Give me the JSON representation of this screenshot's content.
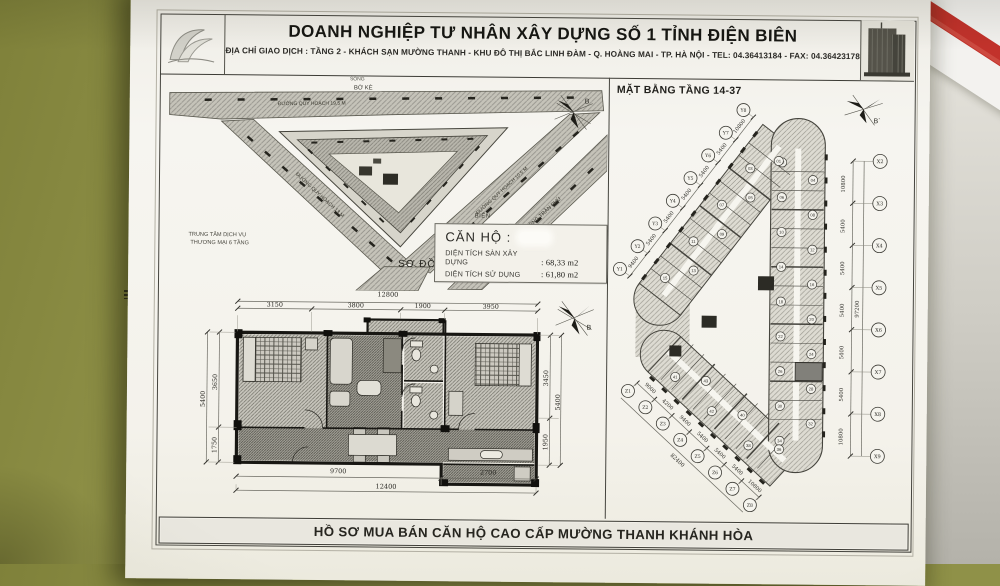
{
  "header": {
    "company": "DOANH NGHIỆP TƯ NHÂN XÂY DỰNG SỐ 1 TỈNH ĐIỆN BIÊN",
    "address": "ĐỊA CHỈ GIAO DỊCH : TẦNG 2 - KHÁCH SẠN MƯỜNG THANH - KHU ĐÔ THỊ BẮC LINH ĐÀM - Q. HOÀNG MAI - TP. HÀ NỘI - TEL: 04.36413184 - FAX: 04.36423178"
  },
  "site_plan": {
    "river": "SÔNG",
    "embankment": "BỜ KÈ",
    "road_top": "ĐƯỜNG QUY HOẠCH 19,5 M",
    "road_left": "ĐƯỜNG QUY HOẠCH 13 M",
    "road_right": "ĐƯỜNG QUY HOẠCH 10,5 M",
    "road_tran_phu": "ĐƯỜNG TRẦN PHÚ",
    "commercial_line1": "TRUNG TÂM DỊCH VỤ",
    "commercial_line2": "THƯƠNG MẠI 6 TẦNG",
    "sea": "BIỂN",
    "caption": "SƠ ĐỒ VỊ TRÍ"
  },
  "unit_info": {
    "title": "CĂN HỘ :",
    "floor_area_label": "DIỆN TÍCH SÀN XÂY DỰNG",
    "floor_area_value": ": 68,33 m2",
    "usable_area_label": "DIỆN TÍCH SỬ DỤNG",
    "usable_area_value": ": 61,80 m2"
  },
  "floor_plan": {
    "title": "MẶT BẰNG TẦNG 14-37",
    "compass_b": "B",
    "compass_b2": "B`",
    "x_axis": [
      "X2",
      "X3",
      "X4",
      "X5",
      "X6",
      "X7",
      "X8",
      "X9"
    ],
    "x_dims": [
      "10800",
      "5400",
      "5400",
      "5400",
      "5400",
      "5400",
      "10800"
    ],
    "x_total": "97200",
    "y_axis": [
      "Y1",
      "Y2",
      "Y3",
      "Y4",
      "Y5",
      "Y6",
      "Y7",
      "Y8"
    ],
    "y_dims": [
      "9400",
      "5400",
      "5400",
      "5400",
      "5400",
      "5400",
      "10800"
    ],
    "z_axis": [
      "Z1",
      "Z2",
      "Z3",
      "Z4",
      "Z5",
      "Z6",
      "Z7",
      "Z8"
    ],
    "z_dims": [
      "9000",
      "4200",
      "9400",
      "5400",
      "5400",
      "5400",
      "10800"
    ],
    "z_total": "82400",
    "right_units": [
      "02",
      "04",
      "06",
      "08",
      "10",
      "12",
      "14",
      "16",
      "18",
      "20",
      "22",
      "24",
      "26",
      "28",
      "30",
      "32",
      "34"
    ],
    "diag_units": [
      "15",
      "13",
      "11",
      "09",
      "07",
      "05",
      "03",
      "01"
    ],
    "lower_units": [
      "41",
      "43",
      "42",
      "40",
      "38",
      "36"
    ],
    "highlighted_unit": "26"
  },
  "apartment": {
    "top_total": "12800",
    "top_dims": [
      "3150",
      "3800",
      "1900",
      "3950"
    ],
    "left_dims": [
      "3650",
      "1750"
    ],
    "left_total": "5400",
    "right_dims": [
      "3450",
      "1950"
    ],
    "right_total": "5400",
    "bottom_dims": [
      "9700",
      "2700"
    ],
    "bottom_total": "12400"
  },
  "footer": {
    "title": "HỒ SƠ MUA BÁN CĂN HỘ CAO CẤP MƯỜNG THANH KHÁNH HÒA"
  }
}
